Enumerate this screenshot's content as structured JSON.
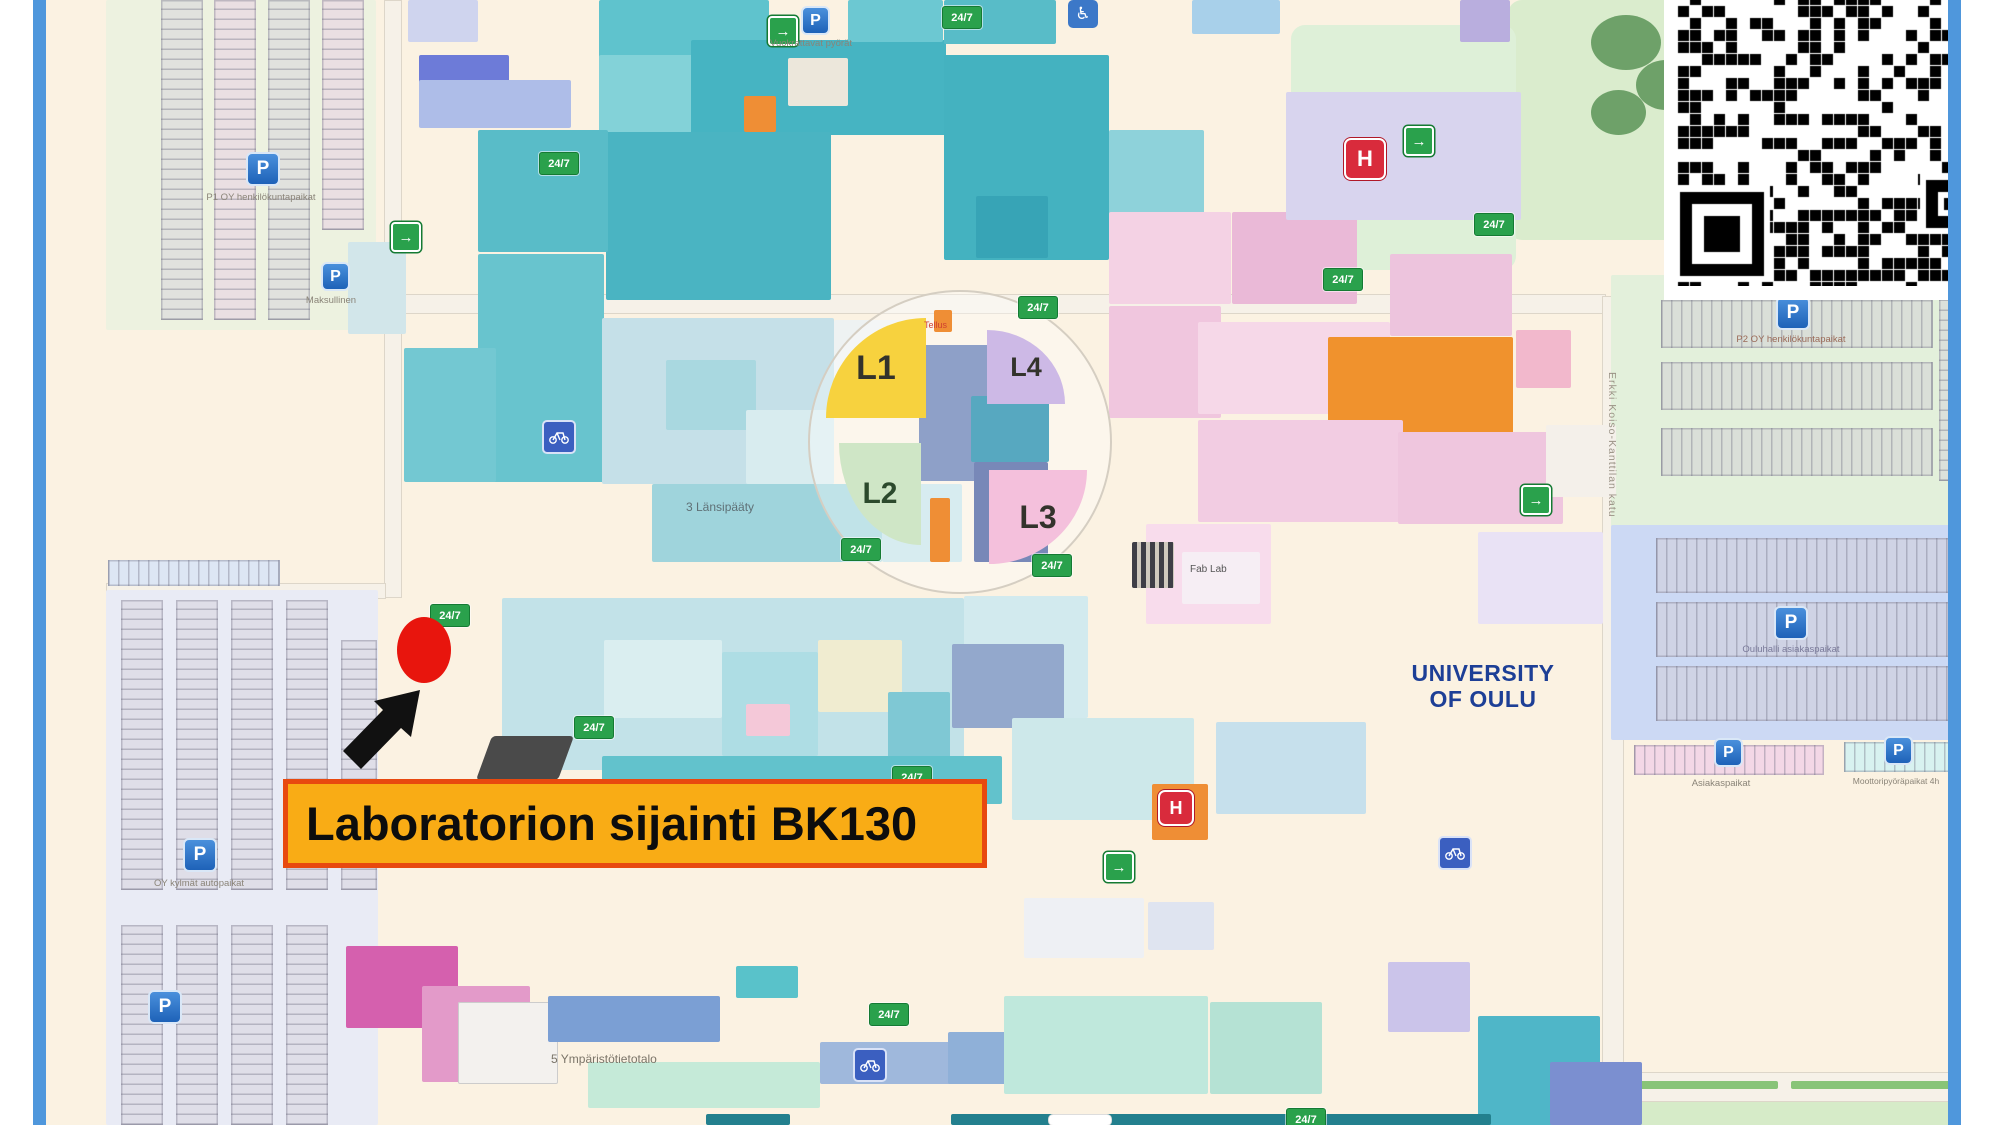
{
  "marker": {
    "label": "Laboratorion sijainti BK130"
  },
  "university": {
    "line1": "UNIVERSITY",
    "line2": "OF OULU"
  },
  "lecture_halls": {
    "l1": "L1",
    "l2": "L2",
    "l3": "L3",
    "l4": "L4"
  },
  "street": {
    "name": "Erkki Koiso-Kanttilan katu"
  },
  "badges": {
    "always_open": "24/7"
  },
  "icons": {
    "parking": "P",
    "restaurant": "H",
    "accessible": "♿",
    "entrance": "→"
  },
  "labels": {
    "bike_rental": "Vuokrattavat pyörät",
    "staff_parking_nw": "P1 OY henkilökuntapaikat",
    "paid_parking": "Maksullinen",
    "cold_parking_sw": "OY kylmät autopaikat",
    "staff_parking_ne": "P2 OY henkilökuntapaikat",
    "visitor_parking_e": "Ouluhalli asiakaspaikat",
    "visitor_parking_s": "Asiakaspaikat",
    "motorcycle_parking": "Moottoripyöräpaikat 4h",
    "environment_building": "5 Ympäristötietotalo",
    "west_end_building": "3 Länsipääty",
    "fab_lab": "Fab Lab",
    "tellus": "Tellus"
  },
  "colors": {
    "frame_blue": "#4f97dc",
    "marker_red": "#e8150d",
    "label_bg": "#f9ac15",
    "label_border": "#e8490f",
    "university_blue": "#1d3f96"
  }
}
